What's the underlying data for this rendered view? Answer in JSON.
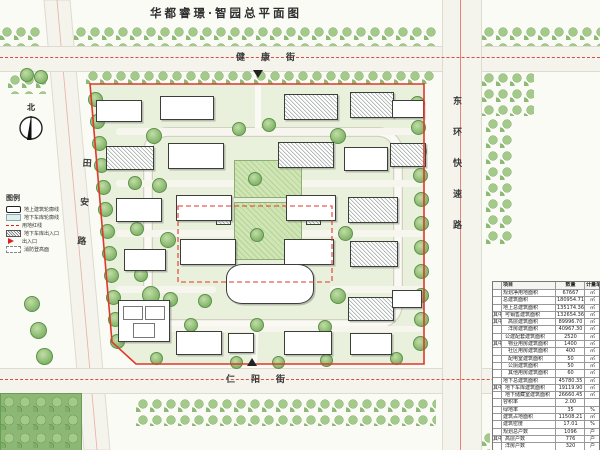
{
  "sheet": {
    "title": "华都睿璟·智园总平面图"
  },
  "compass": {
    "label": "北"
  },
  "streets": {
    "north": "健康街",
    "south": "仁阳街",
    "west": "田安路",
    "east": "东环快速路"
  },
  "legend": {
    "title": "图例",
    "items": [
      {
        "label": "地上建筑轮廓线",
        "swatch": "sw-building",
        "icon": "building-outline-icon"
      },
      {
        "label": "地下车库轮廓线",
        "swatch": "sw-garage",
        "icon": "garage-outline-icon"
      },
      {
        "label": "用地红线",
        "swatch": "sw-redline",
        "icon": "red-boundary-icon"
      },
      {
        "label": "地下车库出入口",
        "swatch": "sw-garage-entry",
        "icon": "garage-entrance-icon"
      },
      {
        "label": "出入口",
        "swatch": "sw-entry",
        "icon": "entrance-arrow-icon"
      },
      {
        "label": "消防登高面",
        "swatch": "sw-fire",
        "icon": "fire-access-icon"
      }
    ]
  },
  "table": {
    "header": [
      "项目",
      "数量",
      "计量单位"
    ],
    "group_label": "其中",
    "rows": [
      {
        "label": "规划净用地面积",
        "value": "67667",
        "unit": "㎡",
        "indent": 0
      },
      {
        "label": "总建筑面积",
        "value": "180954.71",
        "unit": "㎡",
        "indent": 0
      },
      {
        "label": "地上总建筑面积",
        "value": "135174.36",
        "unit": "㎡",
        "indent": 0
      },
      {
        "group": "其中",
        "label": "可销售建筑面积",
        "value": "132654.36",
        "unit": "㎡",
        "indent": 1
      },
      {
        "group": "其中",
        "label": "高层建筑面积",
        "value": "89996.70",
        "unit": "㎡",
        "indent": 2
      },
      {
        "label": "洋房建筑面积",
        "value": "40967.30",
        "unit": "㎡",
        "indent": 2
      },
      {
        "label": "公建配套建筑面积",
        "value": "2520",
        "unit": "㎡",
        "indent": 1
      },
      {
        "group": "其中",
        "label": "物业用房建筑面积",
        "value": "1400",
        "unit": "㎡",
        "indent": 2
      },
      {
        "label": "社区用房建筑面积",
        "value": "400",
        "unit": "㎡",
        "indent": 2
      },
      {
        "label": "配电室建筑面积",
        "value": "50",
        "unit": "㎡",
        "indent": 2
      },
      {
        "label": "公厕建筑面积",
        "value": "50",
        "unit": "㎡",
        "indent": 2
      },
      {
        "label": "其他用房建筑面积",
        "value": "60",
        "unit": "㎡",
        "indent": 2
      },
      {
        "label": "地下总建筑面积",
        "value": "45780.35",
        "unit": "㎡",
        "indent": 0
      },
      {
        "group": "其中",
        "label": "地下车库建筑面积",
        "value": "19119.90",
        "unit": "㎡",
        "indent": 1
      },
      {
        "label": "地下储藏室建筑面积",
        "value": "26660.45",
        "unit": "㎡",
        "indent": 1
      },
      {
        "label": "容积率",
        "value": "2.00",
        "unit": "",
        "indent": 0
      },
      {
        "label": "绿地率",
        "value": "35",
        "unit": "%",
        "indent": 0
      },
      {
        "label": "建筑占地面积",
        "value": "11508.21",
        "unit": "㎡",
        "indent": 0
      },
      {
        "label": "建筑密度",
        "value": "17.01",
        "unit": "%",
        "indent": 0
      },
      {
        "label": "规划总户数",
        "value": "1096",
        "unit": "户",
        "indent": 0
      },
      {
        "group": "其中",
        "label": "高层户数",
        "value": "776",
        "unit": "户",
        "indent": 1
      },
      {
        "label": "洋房户数",
        "value": "320",
        "unit": "户",
        "indent": 1
      },
      {
        "label": "规划居住人数",
        "value": "3507",
        "unit": "人",
        "indent": 0
      },
      {
        "label": "机动车停车位",
        "value": "1312",
        "unit": "个",
        "indent": 0
      },
      {
        "label": "非机动车停车位",
        "value": "2366",
        "unit": "个",
        "indent": 0
      }
    ]
  },
  "colors": {
    "boundary_red": "#e0382a",
    "centerline_red": "#d94f3d",
    "site_green": "#e9f0dc",
    "hedge_green": "#8fbb75",
    "building_outline": "#3a3f3a"
  }
}
